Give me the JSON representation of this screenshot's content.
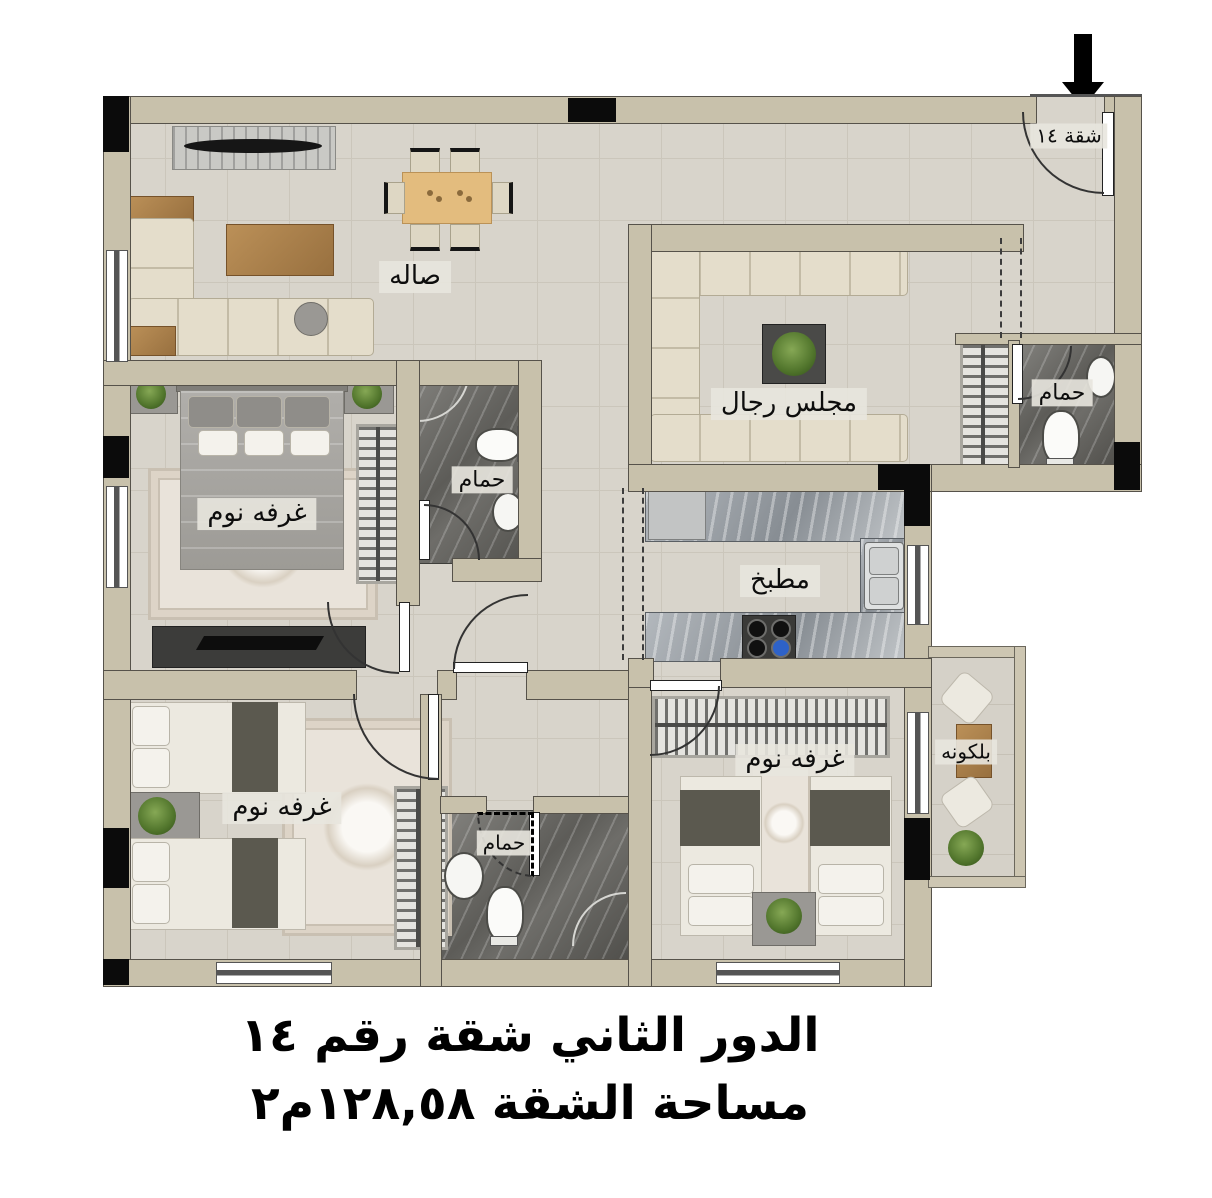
{
  "title": {
    "line1": "الدور الثاني شقة رقم ١٤",
    "line2": "مساحة الشقة ١٢٨,٥٨م٢"
  },
  "labels": {
    "hall": "صاله",
    "majlis": "مجلس رجال",
    "kitchen": "مطبخ",
    "bathroom_entrance": "حمام",
    "bathroom_master": "حمام",
    "bathroom_shared": "حمام",
    "bedroom_master": "غرفه نوم",
    "bedroom_two": "غرفه نوم",
    "bedroom_three": "غرفه نوم",
    "balcony": "بلكونه",
    "apartment_entrance": "شقة ١٤"
  },
  "icons": {
    "entrance_arrow": "down-arrow"
  },
  "colors": {
    "wall": "#c8c1ab",
    "floor": "#d8d4cb",
    "bath_floor": "#5d5c58",
    "counter": "#9aa0a6",
    "column": "#0b0b0b",
    "accent_wood": "#b98f5e",
    "plant": "#51752c"
  }
}
